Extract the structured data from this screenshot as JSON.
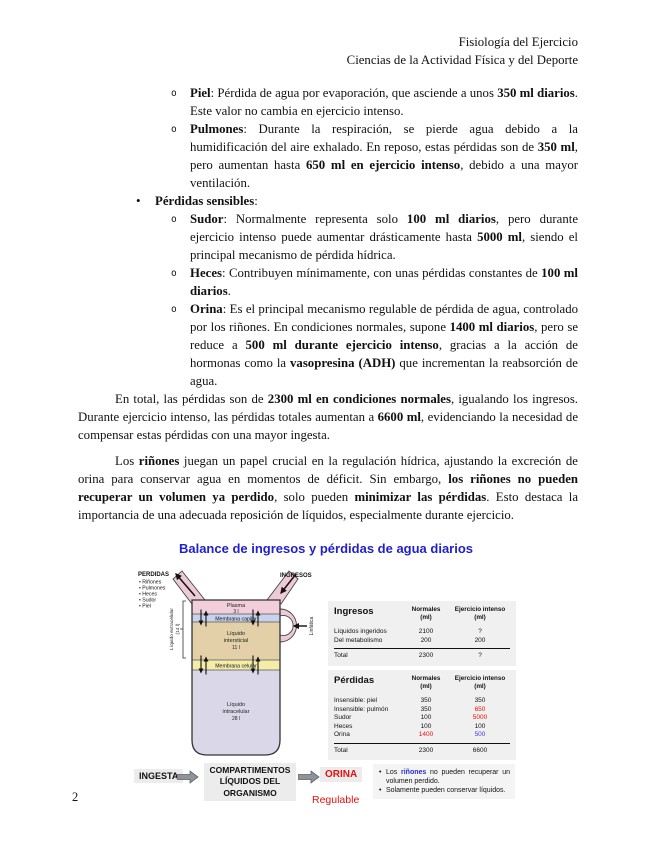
{
  "colors": {
    "figure_title_blue": "#2121cc",
    "alert_red": "#e8100e",
    "value_blue": "#3c3cd8",
    "note_blue": "#2a2ad0",
    "table_bg": "#f0f0f0",
    "plasma_pink": "#f2cedb",
    "capilar_blue": "#c9d2ec",
    "intersticial_tan": "#e3d0a9",
    "celular_yellow": "#f4eca9",
    "intracelular_lavender": "#dad7e9"
  },
  "header": {
    "line1": "Fisiología del Ejercicio",
    "line2": "Ciencias de la Actividad Física y del Deporte"
  },
  "list": {
    "sub_marker": "o",
    "main_marker": "•",
    "items": [
      {
        "segments": [
          {
            "t": "Piel",
            "b": true
          },
          {
            "t": ": Pérdida de agua por evaporación, que asciende a unos "
          },
          {
            "t": "350 ml diarios",
            "b": true
          },
          {
            "t": ". Este valor no cambia en ejercicio intenso."
          }
        ]
      },
      {
        "segments": [
          {
            "t": "Pulmones",
            "b": true
          },
          {
            "t": ": Durante la respiración, se pierde agua debido a la humidificación del aire exhalado. En reposo, estas pérdidas son de "
          },
          {
            "t": "350 ml",
            "b": true
          },
          {
            "t": ", pero aumentan hasta "
          },
          {
            "t": "650 ml en ejercicio intenso",
            "b": true
          },
          {
            "t": ", debido a una mayor ventilación."
          }
        ]
      },
      {
        "segments": [
          {
            "t": "Pérdidas sensibles",
            "b": true
          },
          {
            "t": ":"
          }
        ]
      },
      {
        "segments": [
          {
            "t": "Sudor",
            "b": true
          },
          {
            "t": ": Normalmente representa solo "
          },
          {
            "t": "100 ml diarios",
            "b": true
          },
          {
            "t": ", pero durante ejercicio intenso puede aumentar drásticamente hasta "
          },
          {
            "t": "5000 ml",
            "b": true
          },
          {
            "t": ", siendo el principal mecanismo de pérdida hídrica."
          }
        ]
      },
      {
        "segments": [
          {
            "t": "Heces",
            "b": true
          },
          {
            "t": ": Contribuyen mínimamente, con unas pérdidas constantes de "
          },
          {
            "t": "100 ml diarios",
            "b": true
          },
          {
            "t": "."
          }
        ]
      },
      {
        "segments": [
          {
            "t": "Orina",
            "b": true
          },
          {
            "t": ": Es el principal mecanismo regulable de pérdida de agua, controlado por los riñones. En condiciones normales, supone "
          },
          {
            "t": "1400 ml diarios",
            "b": true
          },
          {
            "t": ", pero se reduce a "
          },
          {
            "t": "500 ml durante ejercicio intenso",
            "b": true
          },
          {
            "t": ", gracias a la acción de hormonas como la "
          },
          {
            "t": "vasopresina (ADH)",
            "b": true
          },
          {
            "t": " que incrementan la reabsorción de agua."
          }
        ]
      }
    ]
  },
  "paragraphs": [
    {
      "segments": [
        {
          "t": "En total, las pérdidas son de "
        },
        {
          "t": "2300 ml en condiciones normales",
          "b": true
        },
        {
          "t": ", igualando los ingresos. Durante ejercicio intenso, las pérdidas totales aumentan a "
        },
        {
          "t": "6600 ml",
          "b": true
        },
        {
          "t": ", evidenciando la necesidad de compensar estas pérdidas con una mayor ingesta."
        }
      ]
    },
    {
      "segments": [
        {
          "t": "Los "
        },
        {
          "t": "riñones",
          "b": true
        },
        {
          "t": " juegan un papel crucial en la regulación hídrica, ajustando la excreción de orina para conservar agua en momentos de déficit. Sin embargo, "
        },
        {
          "t": "los riñones no pueden recuperar un volumen ya perdido",
          "b": true
        },
        {
          "t": ", solo pueden "
        },
        {
          "t": "minimizar las pérdidas",
          "b": true
        },
        {
          "t": ". Esto destaca la importancia de una adecuada reposición de líquidos, especialmente durante ejercicio."
        }
      ]
    }
  ],
  "figure": {
    "title": "Balance de ingresos y pérdidas de agua diarios",
    "diagram": {
      "perdidas_label": "PERDIDAS",
      "perdidas_items": [
        "• Riñones",
        "• Pulmones",
        "• Heces",
        "• Sudor",
        "• Piel"
      ],
      "ingresos_label": "INGRESOS",
      "plasma": "Plasma",
      "plasma_vol": "3 l",
      "membrana_capilar": "Membrana capilar",
      "intersticial_l1": "Líquido",
      "intersticial_l2": "intersticial",
      "intersticial_vol": "11 l",
      "membrana_celular": "Membrana celular",
      "intracelular_l1": "Líquido",
      "intracelular_l2": "intracelular",
      "intracelular_vol": "28 l",
      "extracelular_label": "Líquido extracelular",
      "extracelular_vol": "(14 l)",
      "linfatica_label": "Linfática"
    },
    "flow": {
      "ingesta": "INGESTA",
      "box_l1": "COMPARTIMENTOS",
      "box_l2": "LÍQUIDOS DEL",
      "box_l3": "ORGANISMO",
      "orina": "ORINA",
      "regulable": "Regulable"
    },
    "tables": {
      "ingresos": {
        "title": "Ingresos",
        "col1_l1": "Normales",
        "col1_l2": "(ml)",
        "col2_l1": "Ejercicio intenso",
        "col2_l2": "(ml)",
        "rows": [
          {
            "label": "Líquidos ingeridos",
            "normal": "2100",
            "intenso": "?"
          },
          {
            "label": "Del metabolismo",
            "normal": "200",
            "intenso": "200"
          }
        ],
        "total": {
          "label": "Total",
          "normal": "2300",
          "intenso": "?"
        }
      },
      "perdidas": {
        "title": "Pérdidas",
        "col1_l1": "Normales",
        "col1_l2": "(ml)",
        "col2_l1": "Ejercicio intenso",
        "col2_l2": "(ml)",
        "rows": [
          {
            "label": "Insensible: piel",
            "normal": "350",
            "intenso": "350"
          },
          {
            "label": "Insensible: pulmón",
            "normal": "350",
            "intenso": "650",
            "intenso_color": "#e8100e"
          },
          {
            "label": "Sudor",
            "normal": "100",
            "intenso": "5000",
            "intenso_color": "#e8100e"
          },
          {
            "label": "Heces",
            "normal": "100",
            "intenso": "100"
          },
          {
            "label": "Orina",
            "normal": "1400",
            "normal_color": "#e8100e",
            "intenso": "500",
            "intenso_color": "#3c3cd8"
          }
        ],
        "total": {
          "label": "Total",
          "normal": "2300",
          "intenso": "6600"
        }
      }
    },
    "notes": {
      "marker": "•",
      "items": [
        {
          "segments": [
            {
              "t": "Los "
            },
            {
              "t": "riñones",
              "b": true,
              "c": "#2a2ad0"
            },
            {
              "t": " no pueden recuperar un volumen perdido."
            }
          ]
        },
        {
          "segments": [
            {
              "t": "Solamente pueden conservar líquidos."
            }
          ]
        }
      ]
    }
  },
  "page_number": "2"
}
